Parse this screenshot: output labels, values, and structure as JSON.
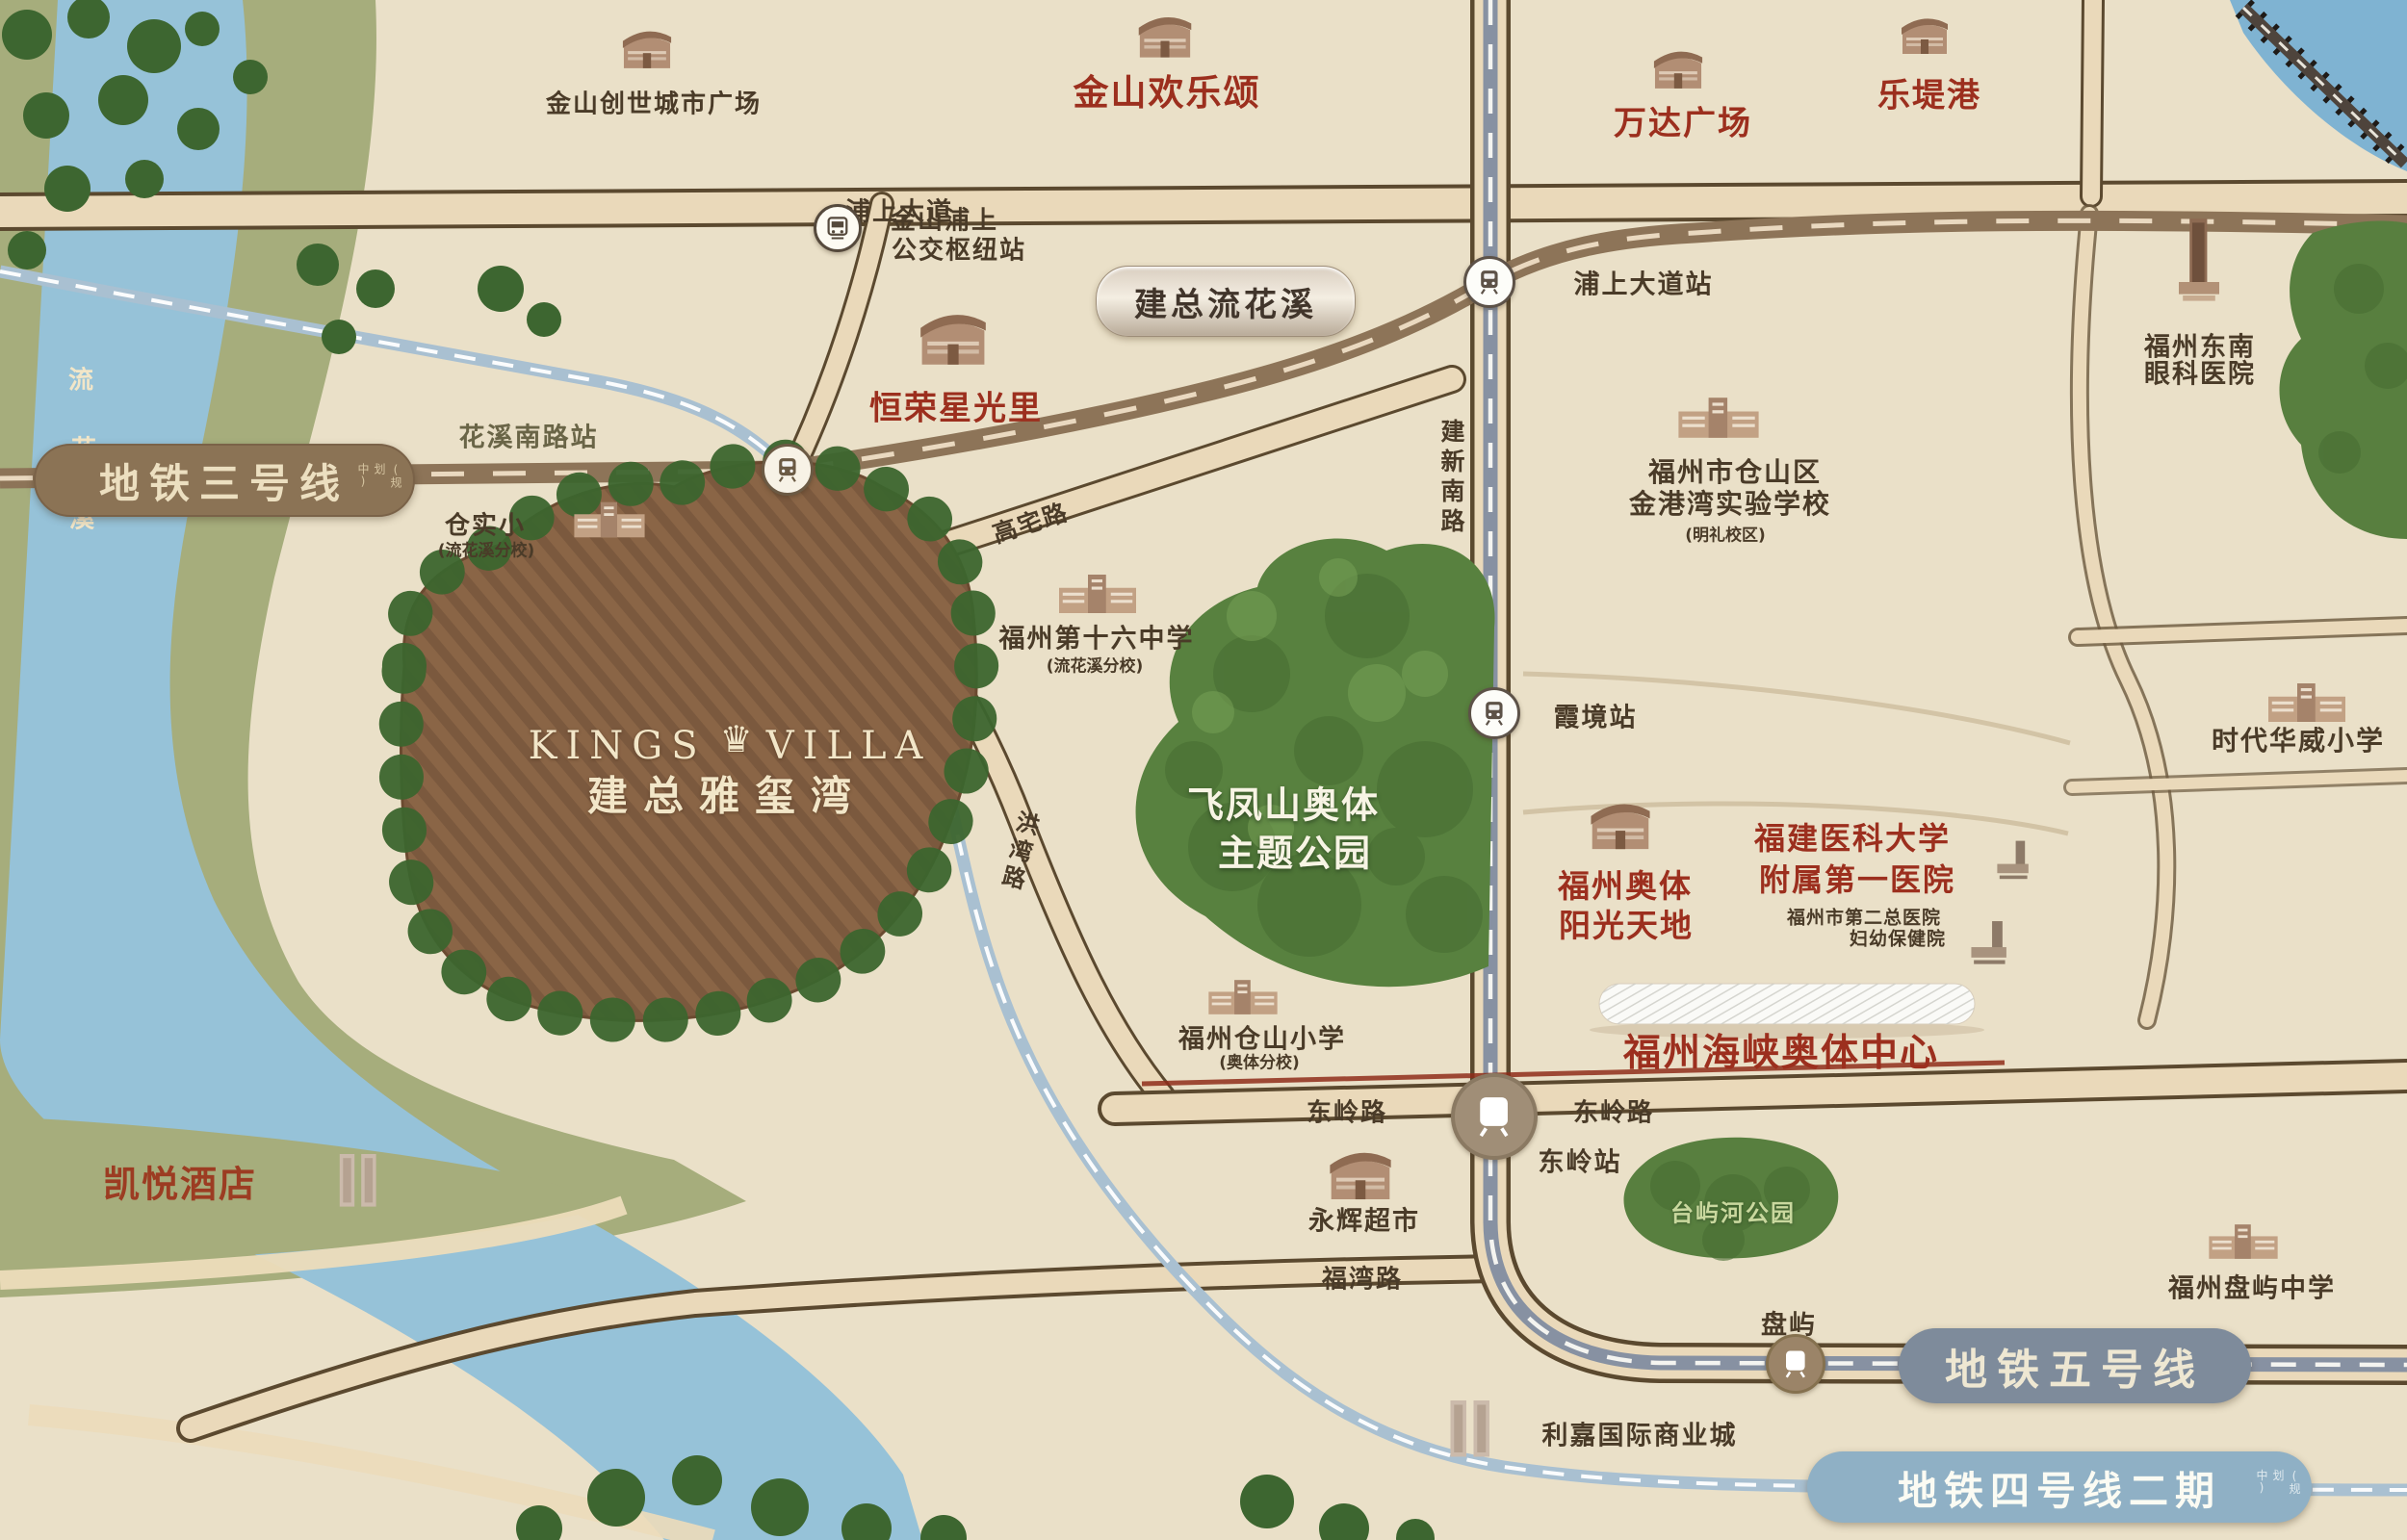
{
  "map": {
    "property": {
      "en_left": "KINGS",
      "crown": "♛",
      "en_right": "VILLA",
      "zh": "建总雅玺湾"
    },
    "badges": {
      "line3": {
        "label": "地铁三号线",
        "note": "(规划中)"
      },
      "line5": {
        "label": "地铁五号线"
      },
      "line4": {
        "label": "地铁四号线二期",
        "note": "(规划中)"
      }
    },
    "stations": {
      "huaxi_south": "花溪南路站",
      "pushang": "浦上大道站",
      "xiajing": "霞境站",
      "dongling": "东岭站",
      "panyu": "盘屿"
    },
    "roads": {
      "pushang_avenue": "浦上大道",
      "gaozhai": "高宅路",
      "jianxin_south": "建新南路",
      "hongwan": "洪湾路",
      "dongling_w": "东岭路",
      "dongling_e": "东岭路",
      "fuwan": "福湾路"
    },
    "river": {
      "c0": "流",
      "c1": "花",
      "c2": "溪"
    },
    "commercial": {
      "jinshan_plaza": "金山创世城市广场",
      "jinshan_joy": "金山欢乐颂",
      "wanda": "万达广场",
      "ledigang": "乐堤港",
      "hengrong": "恒荣星光里",
      "jianzong_liuhuaxi": "建总流花溪",
      "aoti_sunshine_1": "福州奥体",
      "aoti_sunshine_2": "阳光天地",
      "aoti_center": "福州海峡奥体中心",
      "yonghui": "永辉超市",
      "kaiyue": "凯悦酒店",
      "lijia": "利嘉国际商业城"
    },
    "transit_pois": {
      "bus_hub_1": "金山浦上",
      "bus_hub_2": "公交枢纽站"
    },
    "education": {
      "cangshixiao": "仓实小",
      "cangshixiao_note": "(流花溪分校)",
      "jingang_1": "福州市仓山区",
      "jingang_2": "金港湾实验学校",
      "jingang_note": "(明礼校区)",
      "no16": "福州第十六中学",
      "no16_note": "(流花溪分校)",
      "cangshan_primary": "福州仓山小学",
      "cangshan_primary_note": "(奥体分校)",
      "shidai": "时代华威小学",
      "panyu_school": "福州盘屿中学"
    },
    "medical": {
      "dongnan_1": "福州东南",
      "dongnan_2": "眼科医院",
      "fjmu_1": "福建医科大学",
      "fjmu_2": "附属第一医院",
      "second_1": "福州市第二总医院",
      "second_2": "妇幼保健院"
    },
    "parks": {
      "feifeng_1": "飞凤山奥体",
      "feifeng_2": "主题公园",
      "taiyuhe": "台屿河公园"
    },
    "colors": {
      "landmark_red": "#9c2f1e",
      "line3_brown": "#8b7355",
      "line5_slate": "#7e8b9b",
      "line4_blue": "#8fb0c5",
      "water": "#96c2d8",
      "field_brown": "#8a6546"
    }
  }
}
